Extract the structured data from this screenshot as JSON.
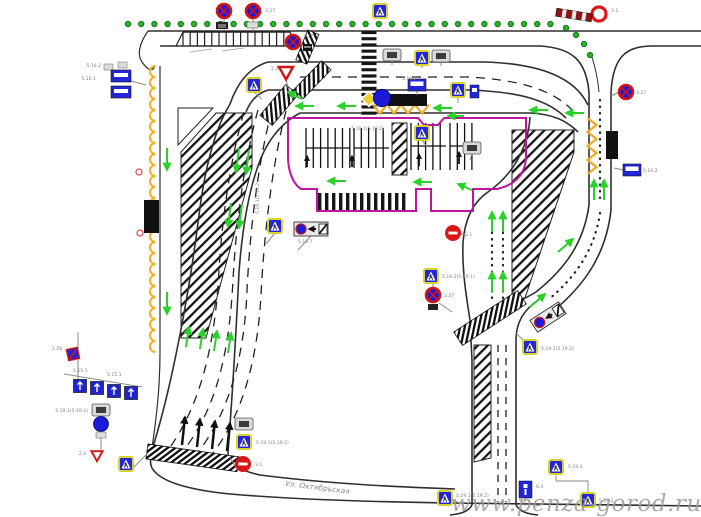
{
  "page": {
    "background": "#ffffff"
  },
  "watermark": {
    "text": "www.penza-gorod.ru"
  },
  "street": {
    "name": "Ул. Октябрьская"
  },
  "colors": {
    "road_line": "#2f2f2f",
    "marking_green": "#2bd12b",
    "tree_green": "#27b527",
    "parking_outline": "#c013a0",
    "bus_zigzag_orange": "#f2a81e",
    "roadside_scallop_orange": "#f0b42c",
    "sign_blue": "#2326d8",
    "sign_red": "#d41414",
    "sign_plate_yellow": "#d9d22a",
    "pavement_black": "#111111",
    "watermark_gray": "#9b9b9b",
    "label_gray": "#808080"
  },
  "sign_kinds": [
    "pedestrian-crossing-sign",
    "no-stopping-sign",
    "no-entry-sign",
    "yield-sign",
    "priority-road-sign",
    "mandatory-direction-sign",
    "bus-stop-sign",
    "route-plate-sign",
    "lane-control-sign",
    "no-parking-sign",
    "parking-info-sign",
    "lane-direction-panel"
  ],
  "tiny_labels": [
    {
      "text": "3.27"
    },
    {
      "text": "3.1"
    },
    {
      "text": "2.4"
    },
    {
      "text": "3.27"
    },
    {
      "text": "5.19.1(5.19.2)"
    },
    {
      "text": "5.15.7"
    },
    {
      "text": "5.19.1(5.19.2)"
    },
    {
      "text": "3.27"
    },
    {
      "text": "5.16.2"
    },
    {
      "text": "5.19.2(5.19.1)"
    },
    {
      "text": "3.27"
    },
    {
      "text": "3.1"
    },
    {
      "text": "5.19.1(5.19.2)"
    },
    {
      "text": "5.16.2"
    },
    {
      "text": "5.16.1"
    },
    {
      "text": "3.28"
    },
    {
      "text": "5.15.1"
    },
    {
      "text": "5.19.1(5.19.2)"
    },
    {
      "text": "2.4"
    },
    {
      "text": "5.19.1(5.19.2)"
    },
    {
      "text": "3.1"
    },
    {
      "text": "5.19.1(5.19.2)"
    },
    {
      "text": "6.4"
    },
    {
      "text": "5.19.1"
    },
    {
      "text": "5.19.2"
    },
    {
      "text": "5.16.2"
    }
  ]
}
